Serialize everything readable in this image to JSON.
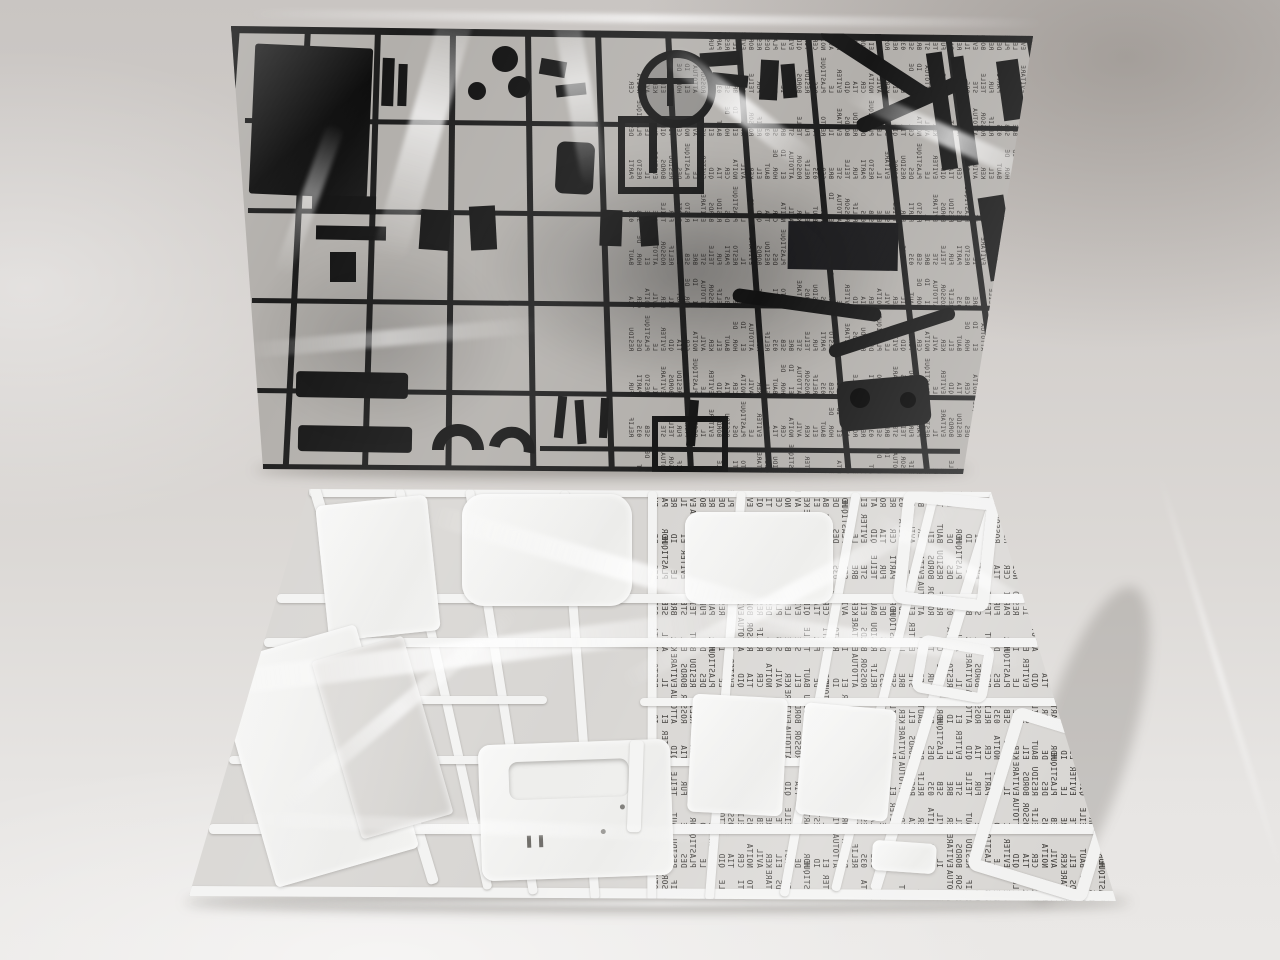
{
  "scene": {
    "description": "Photograph of two injection-molded model-kit part sprues sealed in clear plastic bags, laid on a printed multilingual instruction sheet on a light grey surface. The upper sprue holds black chassis parts; the lower sprue holds white truck-cab body panels.",
    "background_color": "#d8d5d2",
    "surface": "light grey cloth/paper surface with soft shadows"
  },
  "black_sprue": {
    "label": "black chassis parts sprue in clear bag",
    "plastic_color": "#1a1a1a",
    "notable_parts": [
      "flat panel",
      "steering wheel",
      "wheels",
      "ladder frame",
      "roll bar",
      "bumper bars",
      "wheel arches",
      "leaf springs",
      "axle housing",
      "shock absorbers"
    ]
  },
  "white_sprue": {
    "label": "white body panel sprue in clear bag",
    "plastic_color": "#f3f3f2",
    "notable_parts": [
      "cab side panel",
      "roof panel",
      "rear panel",
      "window frames",
      "tall side panel",
      "floor plate",
      "hood panel",
      "door panels"
    ]
  },
  "instruction_sheet": {
    "label": "printed instruction text seen mirrored and rotated through the bags",
    "text_color": "#2e2c29",
    "fragments": [
      "EVITER",
      "LE",
      "PLASTIQUE",
      "DES",
      "RESIDU",
      "BORDS",
      "EVITARE",
      "IL",
      "RESTO",
      "PARTI",
      "FUR",
      "TEILE",
      "STE",
      "BRE",
      "SEB",
      "035",
      "RELIF",
      "ROSSOR",
      "ATTOTUA",
      "EI",
      "ID",
      "HOR",
      "DE",
      "BAUT",
      "EIL",
      "KER",
      "AVIL",
      "NOITA",
      "CER",
      "TIA",
      "QID"
    ]
  }
}
